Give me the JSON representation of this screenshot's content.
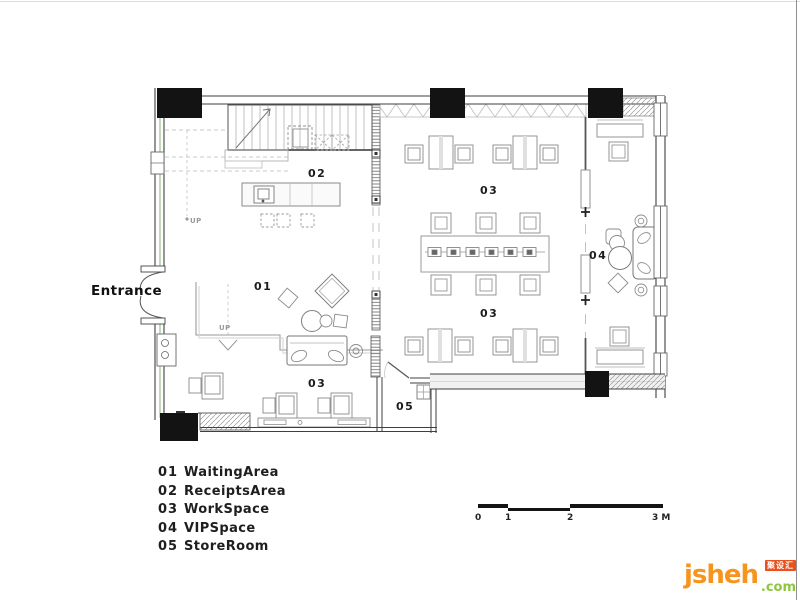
{
  "plan": {
    "entrance_label": "Entrance",
    "up_label": "UP",
    "room_labels": [
      {
        "id": "waiting-area",
        "text": "01"
      },
      {
        "id": "receipts-area",
        "text": "02"
      },
      {
        "id": "workspace-top",
        "text": "03"
      },
      {
        "id": "workspace-bottom",
        "text": "03"
      },
      {
        "id": "workspace-left",
        "text": "03"
      },
      {
        "id": "vip-space",
        "text": "04"
      },
      {
        "id": "store-room",
        "text": "05"
      }
    ]
  },
  "legend": {
    "items": [
      {
        "code": "01",
        "label": "WaitingArea"
      },
      {
        "code": "02",
        "label": "ReceiptsArea"
      },
      {
        "code": "03",
        "label": "WorkSpace"
      },
      {
        "code": "04",
        "label": "VIPSpace"
      },
      {
        "code": "05",
        "label": "StoreRoom"
      }
    ]
  },
  "scale_bar": {
    "tick_labels": [
      "0",
      "1",
      "2",
      "3 M"
    ]
  },
  "logo": {
    "name": "jsheh",
    "tld": ".com",
    "badge": "聚设汇"
  },
  "colors": {
    "logo_orange": "#F7941E",
    "logo_green": "#8DC63F",
    "badge_red": "#E8501E",
    "wall_black": "#131313",
    "accent_green": "#9FBF90"
  }
}
